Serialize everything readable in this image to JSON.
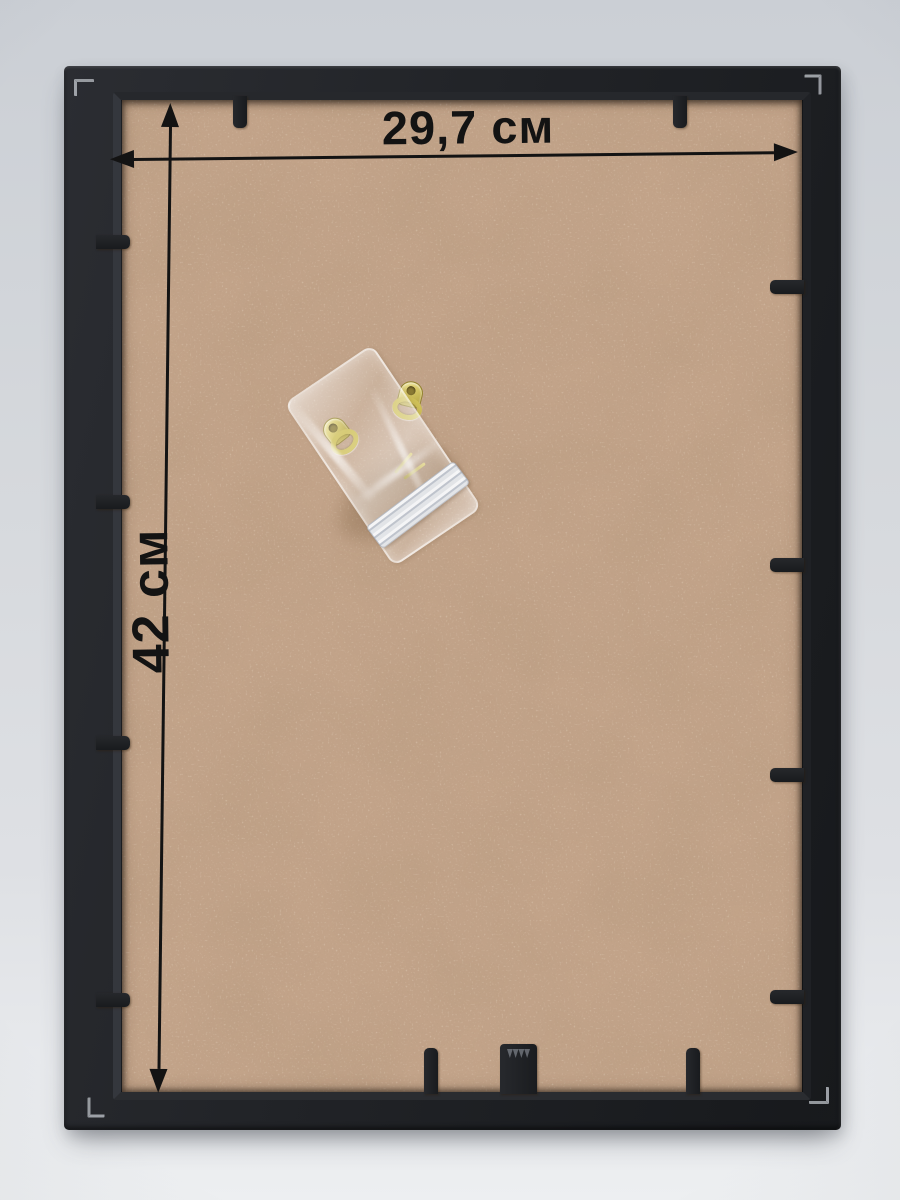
{
  "scene": {
    "subject": "back view of an empty picture frame photographed on a light grey background"
  },
  "annotations": {
    "width_label": "29,7 см",
    "height_label": "42 см",
    "color": "#131313"
  },
  "frame": {
    "outer_color": "#212327",
    "backing_color": "#c2a389",
    "backing_material": "mdf-hardboard",
    "clips": {
      "top_x": [
        240,
        680
      ],
      "bottom_x": [
        431,
        693
      ],
      "left_y": [
        242,
        502,
        743,
        1000
      ],
      "right_y": [
        287,
        565,
        775,
        997
      ]
    },
    "sawtooth_hanger_x": 518,
    "corner_bracket_count": 4
  },
  "hardware_bag": {
    "type": "transparent-ziplock-bag",
    "contents": [
      "d-ring hanger",
      "d-ring hanger",
      "nails"
    ],
    "hardware_color": "#cfc059"
  },
  "background": {
    "wall_top": "#cbcfd5",
    "wall_bottom": "#edeff1"
  }
}
